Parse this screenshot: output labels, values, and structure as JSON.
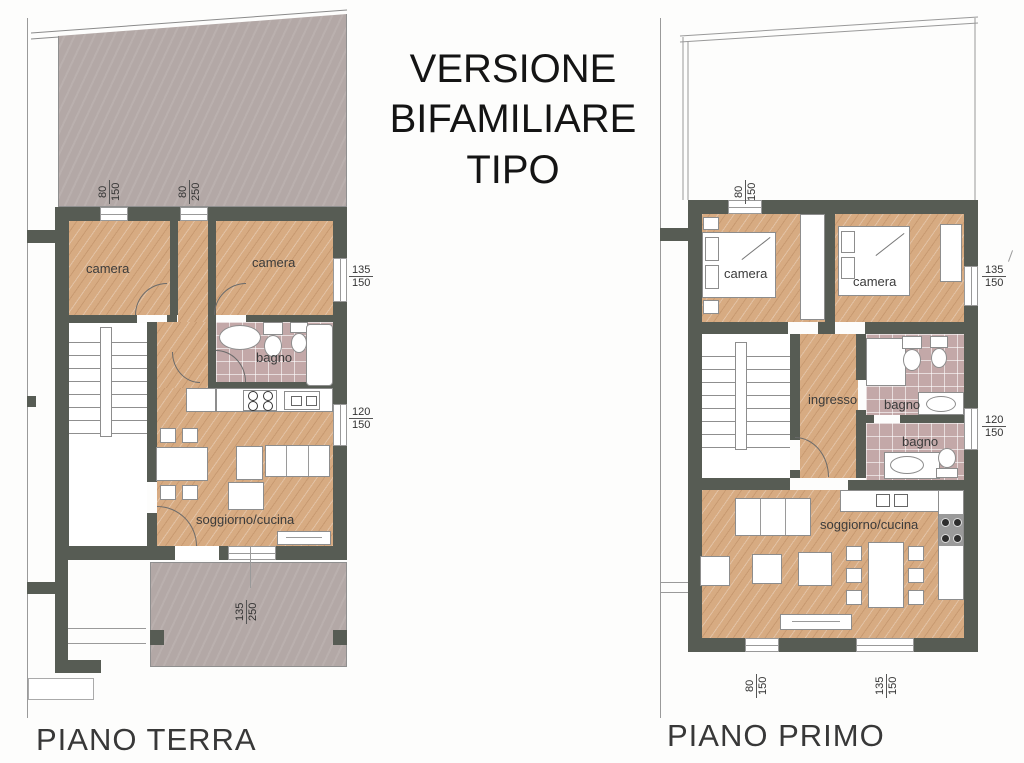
{
  "sheet": {
    "title_lines": [
      "VERSIONE",
      "BIFAMILIARE",
      "TIPO"
    ]
  },
  "ground_floor": {
    "label": "PIANO TERRA",
    "rooms": {
      "camera_left": "camera",
      "camera_right": "camera",
      "bagno": "bagno",
      "living": "soggiorno/cucina"
    },
    "dims": {
      "top_window": {
        "num": "80",
        "den": "150"
      },
      "top_door": {
        "num": "80",
        "den": "250"
      },
      "right_window_upper": {
        "num": "135",
        "den": "150"
      },
      "right_window_lower": {
        "num": "120",
        "den": "150"
      },
      "terrace_door": {
        "num": "135",
        "den": "250"
      }
    }
  },
  "first_floor": {
    "label": "PIANO PRIMO",
    "rooms": {
      "camera_left": "camera",
      "camera_right": "camera",
      "hall": "ingresso",
      "bagno_upper": "bagno",
      "bagno_lower": "bagno",
      "living": "soggiorno/cucina"
    },
    "dims": {
      "top_window": {
        "num": "80",
        "den": "150"
      },
      "right_window_upper": {
        "num": "135",
        "den": "150"
      },
      "right_window_lower": {
        "num": "120",
        "den": "150"
      },
      "bottom_window_left": {
        "num": "80",
        "den": "150"
      },
      "bottom_window_right": {
        "num": "135",
        "den": "150"
      }
    }
  },
  "colors": {
    "wall": "#575c54",
    "wood_floor": "#d7ab82",
    "tile_floor": "#c3a8a8",
    "terrace": "#b3a8a6",
    "paper": "#ffffff"
  }
}
